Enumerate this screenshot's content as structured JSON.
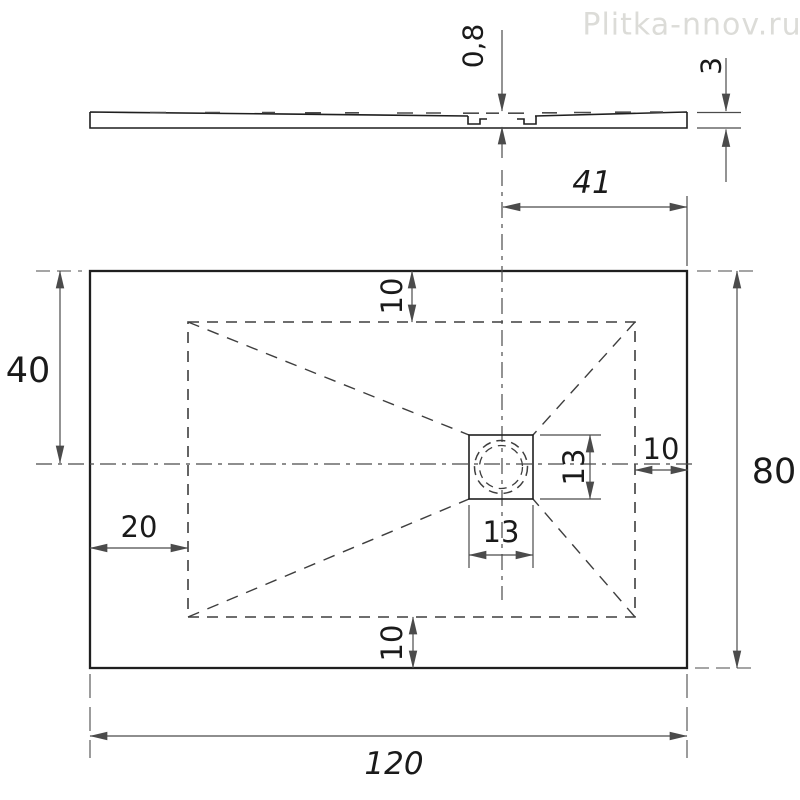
{
  "watermark": "Plitka-nnov.ru",
  "colors": {
    "outline": "#1f1f1f",
    "dim": "#4b4b4b",
    "dash": "#3e3e3e",
    "text": "#1a1a1a",
    "watermark": "#dcdcd8",
    "background": "#ffffff"
  },
  "drawing": {
    "side_profile": {
      "labels": {
        "recess_depth": "0,8",
        "edge_thickness": "3"
      }
    },
    "plan": {
      "labels": {
        "drain_center_to_right": "41",
        "center_to_top": "40",
        "inset_top": "10",
        "inset_right": "10",
        "inset_bottom": "10",
        "inset_left": "20",
        "drain_width": "13",
        "drain_height": "13",
        "overall_width": "120",
        "overall_height": "80"
      }
    }
  }
}
